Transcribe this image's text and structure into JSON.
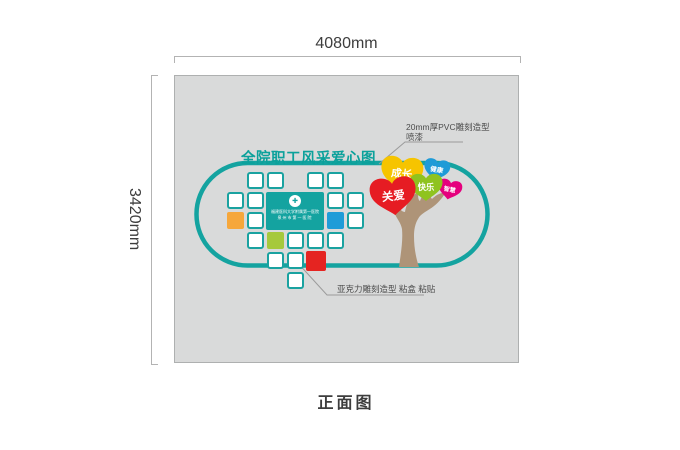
{
  "page": {
    "view_label": "正面图"
  },
  "dimensions": {
    "width_label": "4080mm",
    "height_label": "3420mm"
  },
  "panel": {
    "title": "全院职工风采爱心图"
  },
  "annotations": {
    "pvc": {
      "line1": "20mm厚PVC雕刻造型",
      "line2": "喷漆"
    },
    "acrylic": {
      "text": "亚克力雕刻造型 粘盒 粘贴"
    }
  },
  "badge": {
    "logo_glyph": "✚",
    "line1": "福建医科大学附属第一医院",
    "line2": "泉州市第一医院"
  },
  "hearts": [
    {
      "label": "健康",
      "color": "#1e9bd7",
      "cx": 437,
      "cy": 168,
      "w": 26,
      "rot": 10
    },
    {
      "label": "智慧",
      "color": "#e5007d",
      "cx": 450,
      "cy": 188,
      "w": 24,
      "rot": 12
    },
    {
      "label": "成长",
      "color": "#f6c400",
      "cx": 402,
      "cy": 171,
      "w": 42,
      "rot": 6
    },
    {
      "label": "快乐",
      "color": "#8fc31f",
      "cx": 426,
      "cy": 185,
      "w": 33,
      "rot": 0
    },
    {
      "label": "关爱",
      "color": "#e61c23",
      "cx": 393,
      "cy": 193,
      "w": 46,
      "rot": -6
    }
  ],
  "grid": {
    "cells": [
      {
        "r": 0,
        "c": 1,
        "color": "white"
      },
      {
        "r": 0,
        "c": 2,
        "color": "white"
      },
      {
        "r": 0,
        "c": 4,
        "color": "white"
      },
      {
        "r": 0,
        "c": 5,
        "color": "white"
      },
      {
        "r": 1,
        "c": 0,
        "color": "white"
      },
      {
        "r": 1,
        "c": 1,
        "color": "white"
      },
      {
        "r": 1,
        "c": 5,
        "color": "white"
      },
      {
        "r": 1,
        "c": 6,
        "color": "white"
      },
      {
        "r": 2,
        "c": 0,
        "color": "orange"
      },
      {
        "r": 2,
        "c": 1,
        "color": "white"
      },
      {
        "r": 2,
        "c": 5,
        "color": "blue"
      },
      {
        "r": 2,
        "c": 6,
        "color": "white"
      },
      {
        "r": 3,
        "c": 1,
        "color": "white"
      },
      {
        "r": 3,
        "c": 2,
        "color": "green"
      },
      {
        "r": 3,
        "c": 3,
        "color": "white"
      },
      {
        "r": 3,
        "c": 4,
        "color": "white"
      },
      {
        "r": 3,
        "c": 5,
        "color": "white"
      },
      {
        "r": 4,
        "c": 2,
        "color": "white"
      },
      {
        "r": 4,
        "c": 3,
        "color": "white"
      },
      {
        "r": 4,
        "c": 4,
        "color": "red"
      },
      {
        "r": 5,
        "c": 3,
        "color": "white"
      }
    ]
  },
  "theme": {
    "teal": "#14a3a0",
    "title": "#0ba19b",
    "dimline": "#b3b3b3",
    "dimtext": "#3d3d3d",
    "annot": "#4c4c4c",
    "leader": "#9b9b9b",
    "panel_bg": "#d9dada",
    "panel_border": "#aeb0b0",
    "tree": "#ae9478",
    "grid": {
      "white": "#ffffff",
      "orange": "#f6a73b",
      "blue": "#1f9cd8",
      "green": "#a6c93c",
      "red": "#e52421",
      "border": "#1aa2a0"
    }
  }
}
